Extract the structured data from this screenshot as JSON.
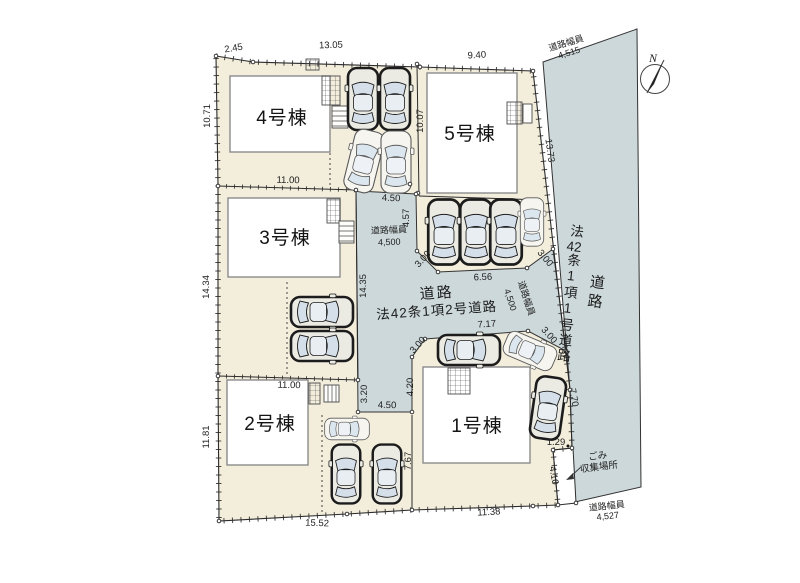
{
  "plan": {
    "buildings": [
      {
        "label": "1号棟"
      },
      {
        "label": "2号棟"
      },
      {
        "label": "3号棟"
      },
      {
        "label": "4号棟"
      },
      {
        "label": "5号棟"
      }
    ],
    "roads": {
      "center_heading": "道路",
      "center_name": "法42条1項2号道路",
      "right_heading": "道路",
      "right_name_p1": "法",
      "right_name_p2": "42",
      "right_name_p3": "条1項1号道路",
      "width_label": "道路幅員",
      "width_top": "4,515",
      "width_bottom": "4,527",
      "width_mid_left": "4,500",
      "width_mid_right": "4,500"
    },
    "garbage_line1": "ごみ",
    "garbage_line2": "収集場所",
    "compass_n": "N",
    "dims": {
      "a245": "2.45",
      "a1305": "13.05",
      "a940": "9.40",
      "a1071": "10.71",
      "a1100t": "11.00",
      "a1434": "14.34",
      "a1100b": "11.00",
      "a1181": "11.81",
      "a1552": "15.52",
      "a1138": "11.38",
      "a1007": "10.07",
      "a450t": "4.50",
      "a457": "4.57",
      "a1435": "14.35",
      "a300nw": "3.00",
      "a656": "6.56",
      "a300ne": "3.00",
      "a717": "7.17",
      "a300sw": "3.00",
      "a300se": "3.00",
      "a320": "3.20",
      "a450s": "4.50",
      "a420": "4.20",
      "a767": "7.67",
      "a770": "7.70",
      "a129": "1.29",
      "a410": "4.10",
      "a1373": "13.73"
    },
    "colors": {
      "lot": "#f3eddc",
      "road": "#cdd8da",
      "building": "#ffffff",
      "line": "#2b2b2b"
    }
  }
}
